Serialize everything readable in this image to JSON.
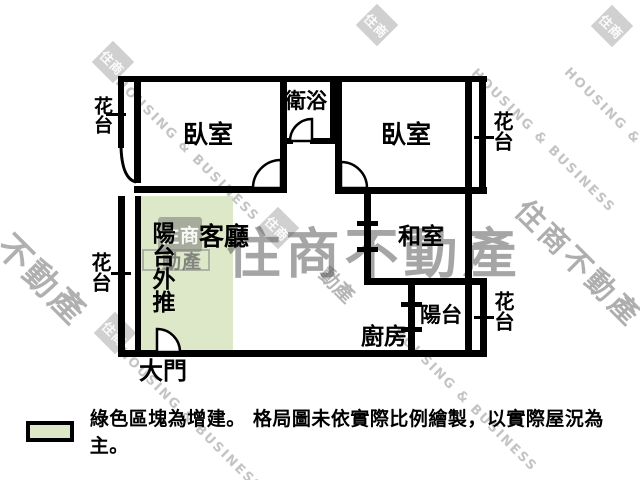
{
  "plan": {
    "rooms": {
      "bedroom_left": "臥室",
      "bedroom_right": "臥室",
      "bathroom": "衛浴",
      "living_room": "客廳",
      "tatami_room": "和室",
      "balcony_pushout": "陽台外推",
      "balcony": "陽台",
      "kitchen": "廚房",
      "main_door": "大門",
      "flower_bed_top_left": "花台",
      "flower_bed_top_right": "花台",
      "flower_bed_bottom_left": "花台",
      "flower_bed_bottom_right": "花台"
    }
  },
  "legend": {
    "note": "綠色區塊為增建。 格局圖未依實際比例繪製，以實際屋況為主。"
  },
  "watermark": {
    "brand_large": "住商不動產",
    "brand_en": "HOUSING & BUSINESS",
    "brand_cjk_left": "不動產",
    "brand_cjk_right": "住商不動產",
    "logo_glyph": "住商",
    "emblem_top": "住商",
    "emblem_bottom": "動產"
  },
  "colors": {
    "addition_green": "#dde8c8",
    "wall_black": "#000000",
    "watermark_gray": "#aeaeae"
  }
}
